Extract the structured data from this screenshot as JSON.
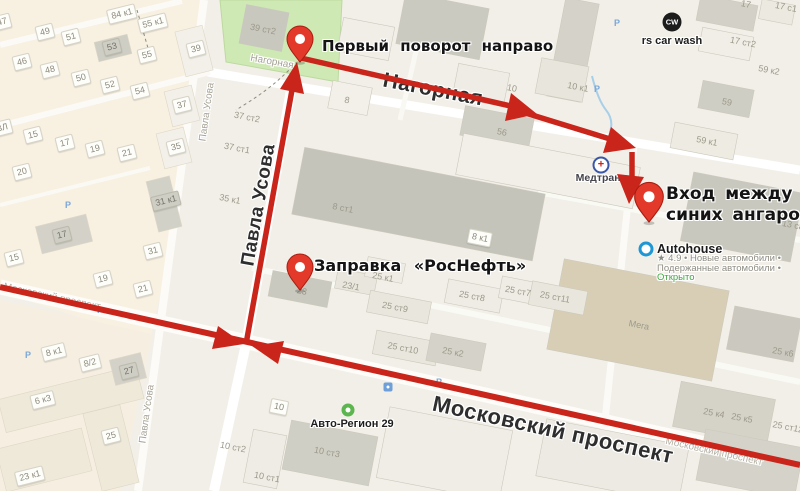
{
  "map": {
    "colors": {
      "route": "#c9251b",
      "pin": "#e2392b",
      "pin_border": "#a81d10",
      "park": "#cfe9b4",
      "open_status": "#3da63d",
      "parking": "#7aa7d8"
    },
    "annotations": {
      "first_turn": "Первый поворот направо",
      "entrance_line1": "Вход между двух",
      "entrance_line2": "синих ангаров",
      "gas_station": "Заправка «РосНефть»"
    },
    "streets": {
      "nagornaya_big": "Нагорная",
      "pavla_usova_big": "Павла Усова",
      "moskovsky_big": "Московский проспект",
      "nagornaya_small": "Нагорная",
      "pavla_usova_small_top": "Павла Усова",
      "pavla_usova_small_bottom": "Павла Усова",
      "moskovsky_small_left": "Московский проспект",
      "moskovsky_small_right": "Московский проспект"
    },
    "pois": {
      "car_wash": {
        "badge": "CW",
        "label": "rs car wash"
      },
      "medtrans": {
        "label": "Медтранс",
        "cross": "+"
      },
      "autohouse": {
        "label": "Autohouse",
        "rating_line": "★ 4.9 • Новые автомобили •",
        "line2": "Подержанные автомобили •",
        "status": "Открыто"
      },
      "avto_region": {
        "label": "Авто-Регион 29"
      }
    },
    "parking_glyph": "Р",
    "parking_icons": [
      {
        "x": 617,
        "y": 23
      },
      {
        "x": 597,
        "y": 89
      },
      {
        "x": 68,
        "y": 205
      },
      {
        "x": 100,
        "y": 310
      },
      {
        "x": 28,
        "y": 355
      },
      {
        "x": 439,
        "y": 382
      },
      {
        "x": 695,
        "y": 442
      },
      {
        "x": 737,
        "y": 452
      }
    ],
    "building_plates": [
      {
        "text": "47",
        "x": 2,
        "y": 22,
        "rot": -14
      },
      {
        "text": "49",
        "x": 45,
        "y": 32,
        "rot": -14
      },
      {
        "text": "51",
        "x": 71,
        "y": 37,
        "rot": -14
      },
      {
        "text": "53",
        "x": 112,
        "y": 47,
        "rot": -14,
        "g": true
      },
      {
        "text": "55",
        "x": 147,
        "y": 55,
        "rot": -14
      },
      {
        "text": "84 к1",
        "x": 122,
        "y": 14,
        "rot": -14
      },
      {
        "text": "55 к1",
        "x": 153,
        "y": 23,
        "rot": -14
      },
      {
        "text": "46",
        "x": 22,
        "y": 62,
        "rot": -14
      },
      {
        "text": "48",
        "x": 50,
        "y": 70,
        "rot": -14
      },
      {
        "text": "50",
        "x": 81,
        "y": 78,
        "rot": -14
      },
      {
        "text": "52",
        "x": 110,
        "y": 85,
        "rot": -14
      },
      {
        "text": "54",
        "x": 140,
        "y": 91,
        "rot": -14
      },
      {
        "text": "39",
        "x": 196,
        "y": 49,
        "rot": -14
      },
      {
        "text": "37",
        "x": 182,
        "y": 105,
        "rot": -14
      },
      {
        "text": "35",
        "x": 176,
        "y": 147,
        "rot": -14
      },
      {
        "text": "ВЛ",
        "x": 2,
        "y": 128,
        "rot": -14
      },
      {
        "text": "15",
        "x": 33,
        "y": 135,
        "rot": -14
      },
      {
        "text": "17",
        "x": 65,
        "y": 143,
        "rot": -14
      },
      {
        "text": "19",
        "x": 95,
        "y": 149,
        "rot": -14
      },
      {
        "text": "21",
        "x": 127,
        "y": 153,
        "rot": -14
      },
      {
        "text": "20",
        "x": 22,
        "y": 172,
        "rot": -14
      },
      {
        "text": "31 к1",
        "x": 166,
        "y": 201,
        "rot": -14,
        "g": true
      },
      {
        "text": "17",
        "x": 62,
        "y": 235,
        "rot": -14,
        "g": true
      },
      {
        "text": "15",
        "x": 14,
        "y": 258,
        "rot": -14
      },
      {
        "text": "31",
        "x": 153,
        "y": 251,
        "rot": -14
      },
      {
        "text": "19",
        "x": 103,
        "y": 279,
        "rot": -14
      },
      {
        "text": "21",
        "x": 143,
        "y": 289,
        "rot": -14
      },
      {
        "text": "8 к1",
        "x": 54,
        "y": 352,
        "rot": -14
      },
      {
        "text": "8/2",
        "x": 90,
        "y": 363,
        "rot": -14
      },
      {
        "text": "27",
        "x": 129,
        "y": 371,
        "rot": -14,
        "g": true
      },
      {
        "text": "6 к3",
        "x": 43,
        "y": 400,
        "rot": -14
      },
      {
        "text": "25",
        "x": 111,
        "y": 436,
        "rot": -14
      },
      {
        "text": "23 к1",
        "x": 30,
        "y": 476,
        "rot": -14
      },
      {
        "text": "10",
        "x": 279,
        "y": 407,
        "rot": 11
      },
      {
        "text": "8 к1",
        "x": 480,
        "y": 238,
        "rot": 11
      }
    ],
    "building_labels": [
      {
        "text": "39 ст2",
        "x": 263,
        "y": 29,
        "rot": 11
      },
      {
        "text": "37 ст2",
        "x": 247,
        "y": 117,
        "rot": 11
      },
      {
        "text": "37 ст1",
        "x": 237,
        "y": 148,
        "rot": 11
      },
      {
        "text": "35 к1",
        "x": 230,
        "y": 199,
        "rot": 11
      },
      {
        "text": "8",
        "x": 347,
        "y": 100,
        "rot": 11
      },
      {
        "text": "8 ст1",
        "x": 343,
        "y": 208,
        "rot": 11
      },
      {
        "text": "56",
        "x": 502,
        "y": 132,
        "rot": 11
      },
      {
        "text": "10",
        "x": 512,
        "y": 88,
        "rot": 11
      },
      {
        "text": "10 к1",
        "x": 578,
        "y": 87,
        "rot": 11
      },
      {
        "text": "17",
        "x": 746,
        "y": 4,
        "rot": 11
      },
      {
        "text": "17 с1",
        "x": 786,
        "y": 7,
        "rot": 11
      },
      {
        "text": "17 ст2",
        "x": 743,
        "y": 42,
        "rot": 11
      },
      {
        "text": "59 к2",
        "x": 769,
        "y": 70,
        "rot": 11
      },
      {
        "text": "59",
        "x": 727,
        "y": 102,
        "rot": 11
      },
      {
        "text": "59 к1",
        "x": 707,
        "y": 141,
        "rot": 11
      },
      {
        "text": "13 с8",
        "x": 793,
        "y": 225,
        "rot": 11
      },
      {
        "text": "23",
        "x": 302,
        "y": 291,
        "rot": 11
      },
      {
        "text": "23/1",
        "x": 351,
        "y": 286,
        "rot": 11
      },
      {
        "text": "25 к1",
        "x": 383,
        "y": 277,
        "rot": 11
      },
      {
        "text": "25 ст9",
        "x": 395,
        "y": 307,
        "rot": 11
      },
      {
        "text": "25 ст8",
        "x": 472,
        "y": 296,
        "rot": 11
      },
      {
        "text": "25 ст7",
        "x": 518,
        "y": 291,
        "rot": 11
      },
      {
        "text": "25 ст11",
        "x": 555,
        "y": 297,
        "rot": 11
      },
      {
        "text": "25 ст10",
        "x": 403,
        "y": 348,
        "rot": 11
      },
      {
        "text": "25 к2",
        "x": 453,
        "y": 352,
        "rot": 11
      },
      {
        "text": "Мега",
        "x": 639,
        "y": 325,
        "rot": 11
      },
      {
        "text": "25 к6",
        "x": 783,
        "y": 352,
        "rot": 11
      },
      {
        "text": "25 к4",
        "x": 714,
        "y": 413,
        "rot": 11
      },
      {
        "text": "25 к5",
        "x": 742,
        "y": 418,
        "rot": 11
      },
      {
        "text": "25 ст12",
        "x": 788,
        "y": 427,
        "rot": 11
      },
      {
        "text": "10 ст2",
        "x": 233,
        "y": 447,
        "rot": 11
      },
      {
        "text": "10 ст3",
        "x": 327,
        "y": 452,
        "rot": 11
      },
      {
        "text": "10 ст1",
        "x": 267,
        "y": 477,
        "rot": 11
      }
    ]
  }
}
